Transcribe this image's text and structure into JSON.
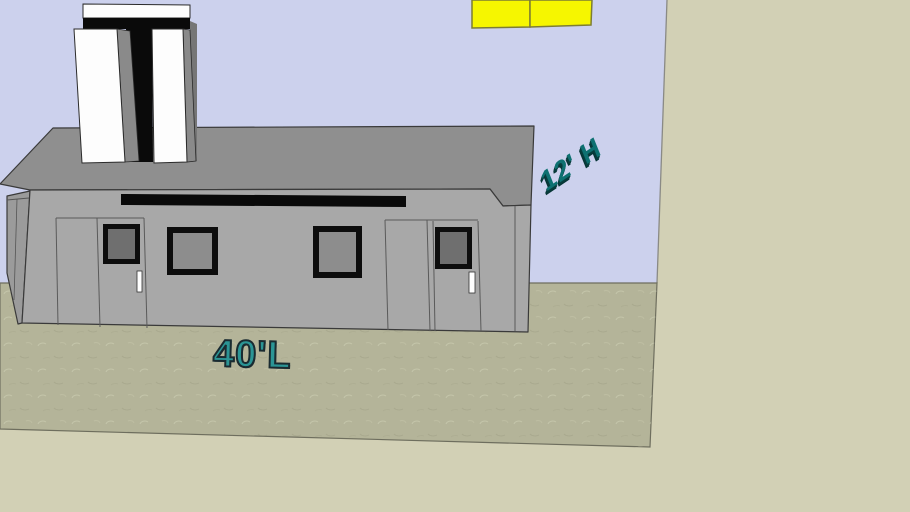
{
  "scene": {
    "annotations": {
      "height_label": "12' H",
      "length_label": "40'L"
    },
    "colors": {
      "sky": "#ccd1ed",
      "backdrop": "#d2d0b5",
      "ground": "#b4b499",
      "roof": "#8f8f8f",
      "front_wall": "#a8a8a8",
      "side_wall": "#9b9b9b",
      "stripe_black": "#0a0a0a",
      "chimney_white": "#fdfdfd",
      "chimney_gray": "#8a8a8a",
      "chimney_dark_gray": "#767676",
      "window_frame": "#0d0d0d",
      "glass_light": "#8d8d8d",
      "glass_dark": "#6f6f6f",
      "handle_white": "#ffffff",
      "panel_yellow": "#f6f600",
      "panel_yellow_border": "#7d7d33",
      "edge_dark": "#3a3a3a",
      "label_teal_dark": "#0e7171",
      "label_teal": "#2b9595"
    }
  }
}
